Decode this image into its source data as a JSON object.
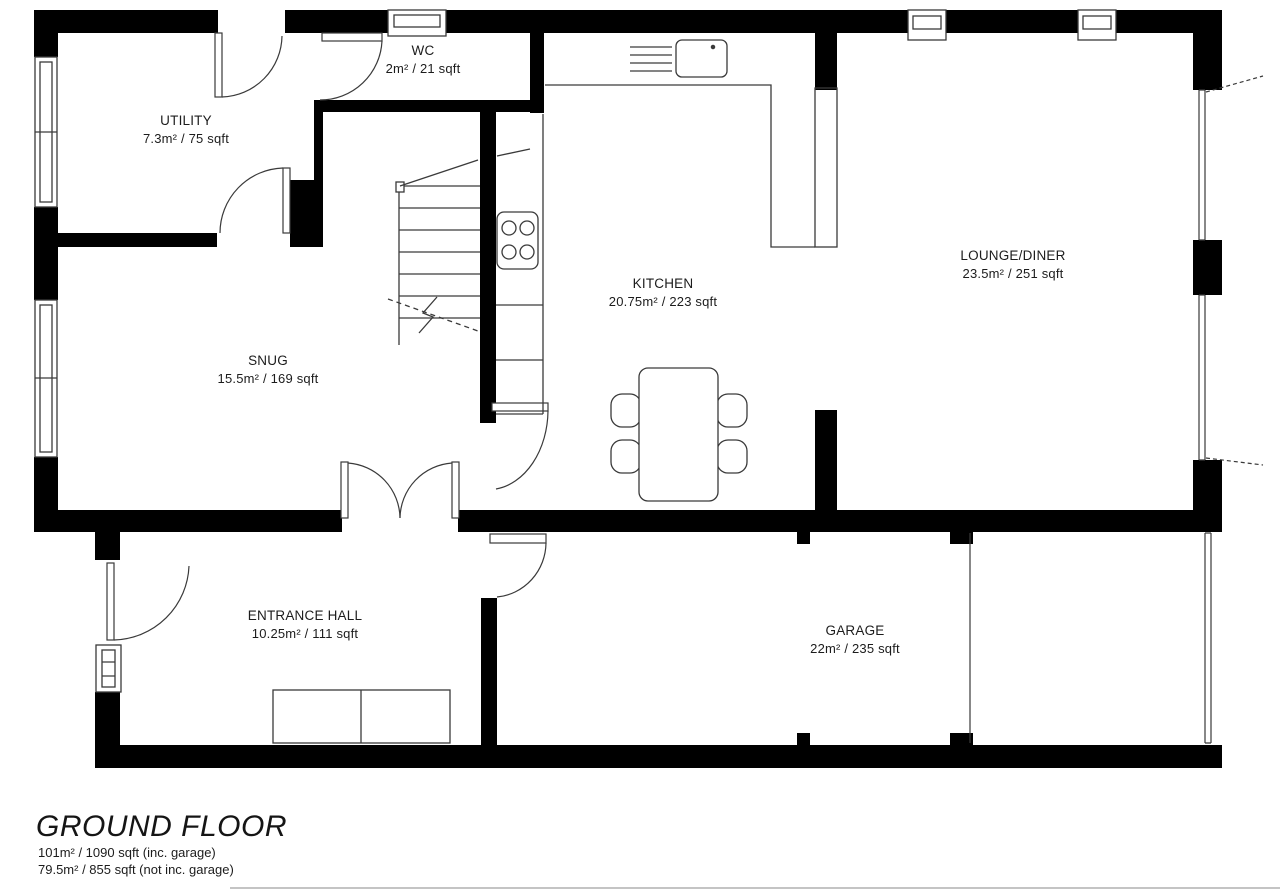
{
  "floorplan": {
    "title": "GROUND FLOOR",
    "totals": [
      "101m² / 1090 sqft (inc. garage)",
      "79.5m² / 855 sqft (not inc. garage)"
    ],
    "rooms": [
      {
        "name": "WC",
        "area": "2m² / 21 sqft"
      },
      {
        "name": "UTILITY",
        "area": "7.3m² / 75 sqft"
      },
      {
        "name": "SNUG",
        "area": "15.5m² / 169 sqft"
      },
      {
        "name": "KITCHEN",
        "area": "20.75m² / 223 sqft"
      },
      {
        "name": "LOUNGE/DINER",
        "area": "23.5m² / 251 sqft"
      },
      {
        "name": "ENTRANCE HALL",
        "area": "10.25m² / 111 sqft"
      },
      {
        "name": "GARAGE",
        "area": "22m² / 235 sqft"
      }
    ],
    "colors": {
      "walls": "#000000",
      "lines": "#3a3a3a",
      "background": "#ffffff"
    }
  }
}
